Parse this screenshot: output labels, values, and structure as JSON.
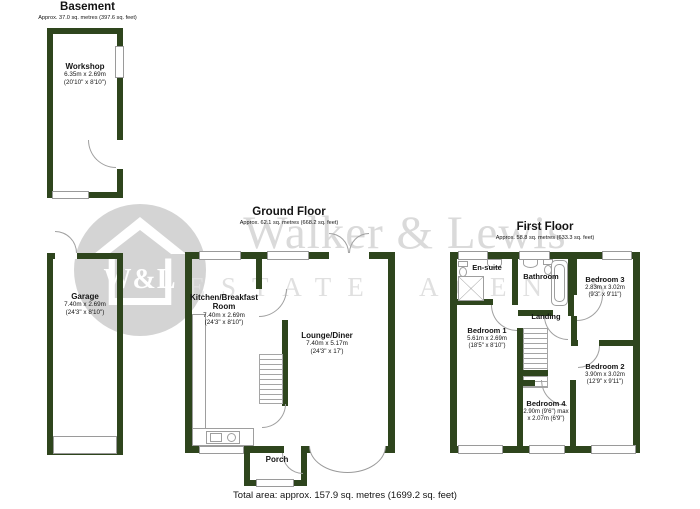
{
  "colors": {
    "wall": "#2e451d",
    "line": "#9a9a9a",
    "watermark": "#d8d8d8"
  },
  "watermark": {
    "brand": "Walker & Lewis",
    "tagline": "ESTATE AGENTS",
    "monogram": "W&L"
  },
  "sections": {
    "basement": {
      "title": "Basement",
      "subtitle": "Approx. 37.0 sq. metres (397.6 sq. feet)"
    },
    "ground": {
      "title": "Ground Floor",
      "subtitle": "Approx. 62.1 sq. metres (668.2 sq. feet)"
    },
    "first": {
      "title": "First Floor",
      "subtitle": "Approx. 58.8 sq. metres (633.3 sq. feet)"
    }
  },
  "rooms": {
    "workshop": {
      "name": "Workshop",
      "metric": "6.35m x 2.69m",
      "imperial": "(20'10\" x 8'10\")"
    },
    "garage": {
      "name": "Garage",
      "metric": "7.40m x 2.69m",
      "imperial": "(24'3\" x 8'10\")"
    },
    "kitchen": {
      "name": "Kitchen/Breakfast Room",
      "metric": "7.40m x 2.69m",
      "imperial": "(24'3\" x 8'10\")"
    },
    "lounge": {
      "name": "Lounge/Diner",
      "metric": "7.40m x 5.17m",
      "imperial": "(24'3\" x 17')"
    },
    "porch": {
      "name": "Porch"
    },
    "ensuite": {
      "name": "En-suite"
    },
    "bathroom": {
      "name": "Bathroom"
    },
    "landing": {
      "name": "Landing"
    },
    "bedroom1": {
      "name": "Bedroom 1",
      "metric": "5.61m x 2.69m",
      "imperial": "(18'5\" x 8'10\")"
    },
    "bedroom2": {
      "name": "Bedroom 2",
      "metric": "3.90m x 3.02m",
      "imperial": "(12'9\" x 9'11\")"
    },
    "bedroom3": {
      "name": "Bedroom 3",
      "metric": "2.83m x 3.02m",
      "imperial": "(9'3\" x 9'11\")"
    },
    "bedroom4": {
      "name": "Bedroom 4",
      "metric": "2.90m (9'6\") max",
      "imperial": "x 2.07m (6'9\")"
    }
  },
  "footer": {
    "total": "Total area: approx. 157.9 sq. metres (1699.2 sq. feet)"
  }
}
